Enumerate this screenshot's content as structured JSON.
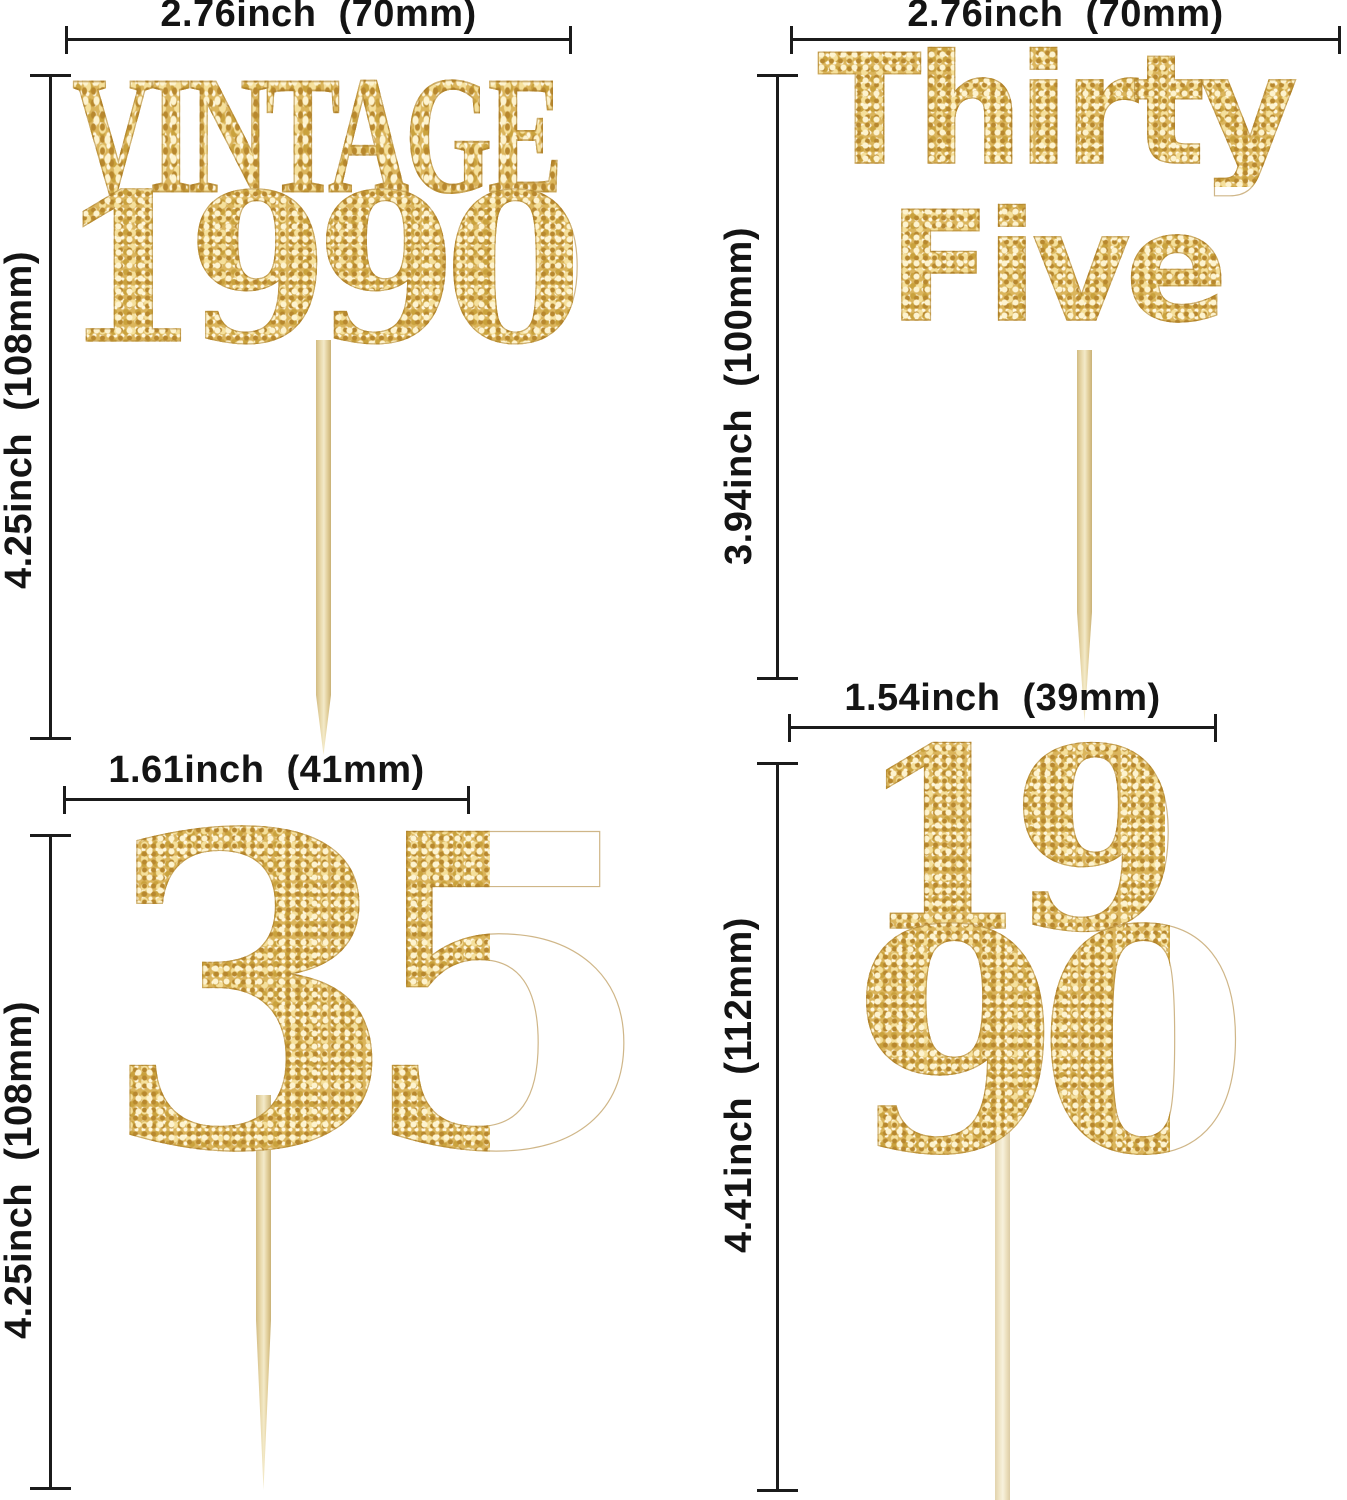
{
  "colors": {
    "gold_base": "#dbb55c",
    "dimension_line": "#1b1b1b",
    "toothpick_wood": "#e8d8aa"
  },
  "toppers": {
    "tl": {
      "line1": "VINTAGE",
      "line2": "1990",
      "width_label": "2.76inch  (70mm)",
      "height_label": "4.25inch  (108mm)"
    },
    "tr": {
      "line1": "Thirty",
      "line2": "Five",
      "width_label": "2.76inch  (70mm)",
      "height_label": "3.94inch  (100mm)"
    },
    "bl": {
      "line1": "35",
      "width_label": "1.61inch  (41mm)",
      "height_label": "4.25inch  (108mm)"
    },
    "br": {
      "line1": "19",
      "line2": "90",
      "width_label": "1.54inch  (39mm)",
      "height_label": "4.41inch  (112mm)"
    }
  }
}
